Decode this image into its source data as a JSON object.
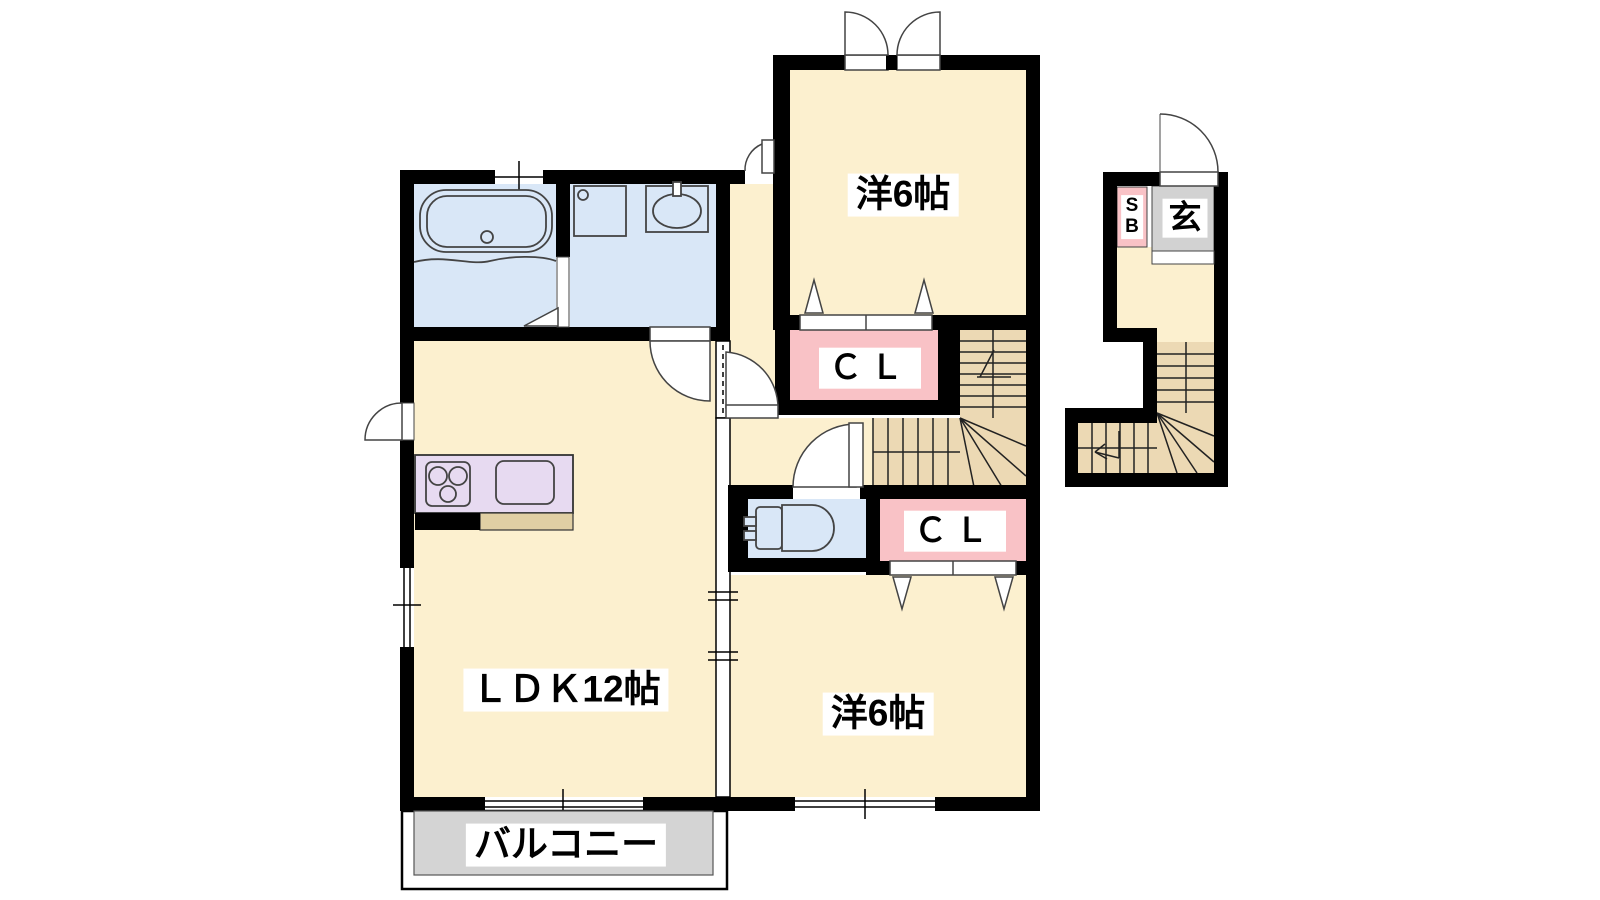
{
  "labels": {
    "bedroom_top": "洋6帖",
    "bedroom_bottom": "洋6帖",
    "ldk": "ＬＤＫ12帖",
    "closet_top": "ＣＬ",
    "closet_bottom": "ＣＬ",
    "entrance": "玄",
    "shoe_box": "S\nB",
    "balcony": "バルコニー"
  },
  "colors": {
    "wall": "#000000",
    "room_floor": "#fcf0cf",
    "stair_tread": "#ecd9b4",
    "closet_pink": "#f9c2c6",
    "water_blue": "#d9e7f7",
    "kitchen_counter": "#e7daf1",
    "counter_lip": "#e0cfa4",
    "balcony_gray": "#d4d4d4",
    "entrance_gray": "#d2d2d2"
  }
}
